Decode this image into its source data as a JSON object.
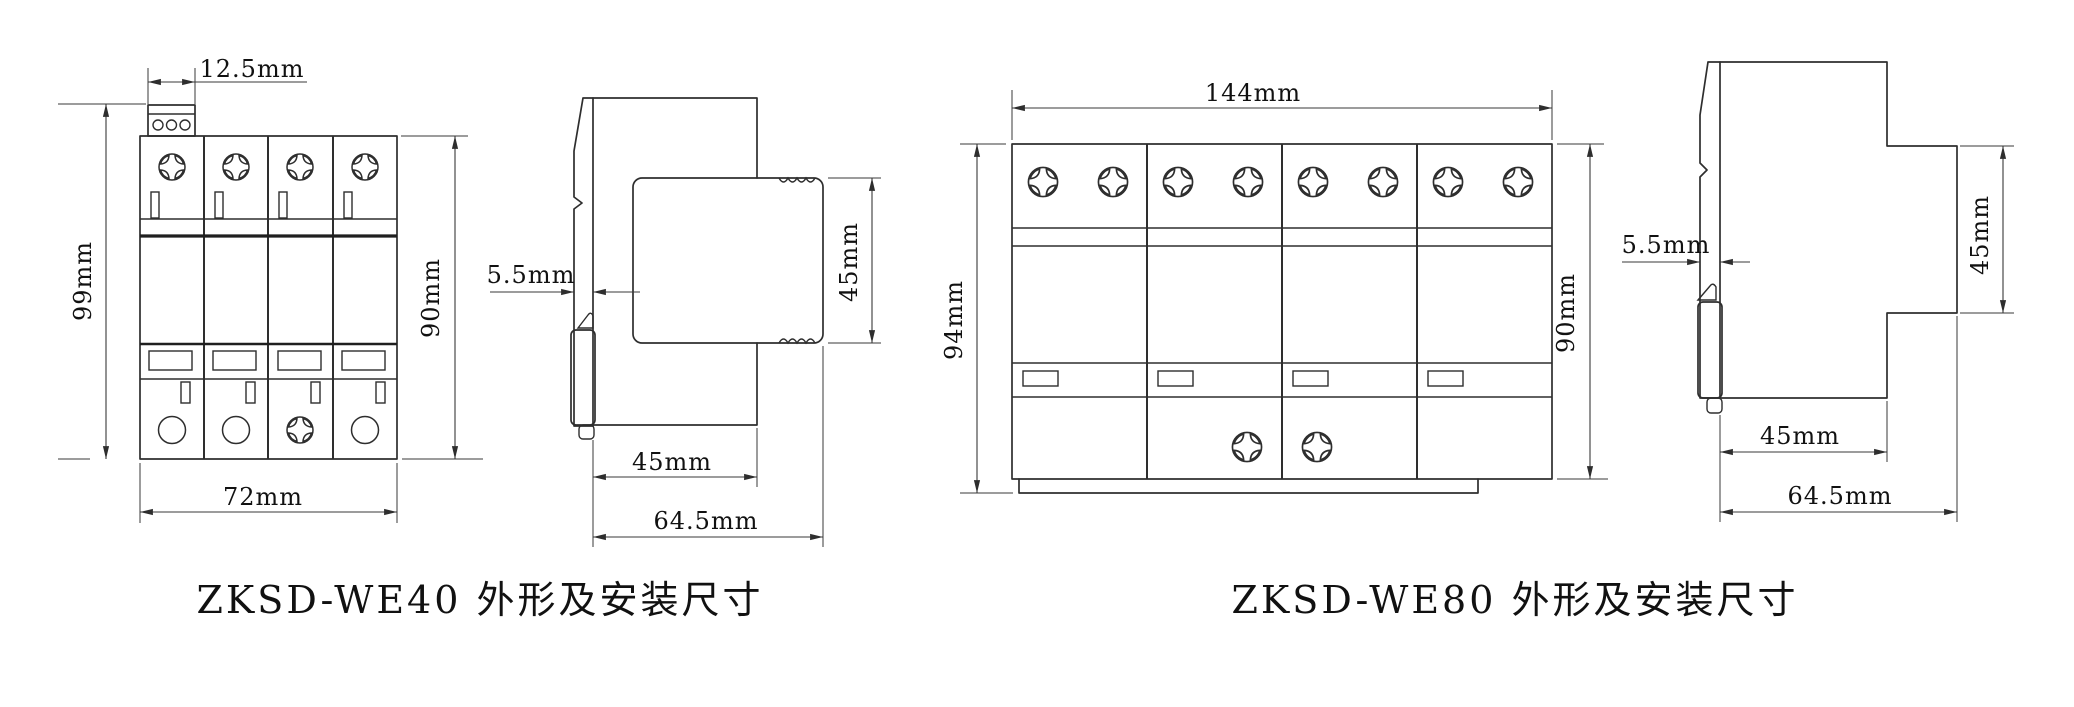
{
  "we40": {
    "caption": "ZKSD-WE40 外形及安装尺寸",
    "front": {
      "terminal_width": "12.5mm",
      "overall_height": "99mm",
      "overall_width": "72mm",
      "body_height": "90mm"
    },
    "side": {
      "rail_depth": "5.5mm",
      "plug_height": "45mm",
      "body_depth": "45mm",
      "overall_depth": "64.5mm"
    }
  },
  "we80": {
    "caption": "ZKSD-WE80 外形及安装尺寸",
    "front": {
      "overall_width": "144mm",
      "overall_height": "94mm",
      "body_height": "90mm"
    },
    "side": {
      "rail_depth": "5.5mm",
      "plug_height": "45mm",
      "body_depth": "45mm",
      "overall_depth": "64.5mm"
    }
  },
  "colors": {
    "line": "#2e2e2e",
    "text": "#111111",
    "background": "#ffffff"
  }
}
